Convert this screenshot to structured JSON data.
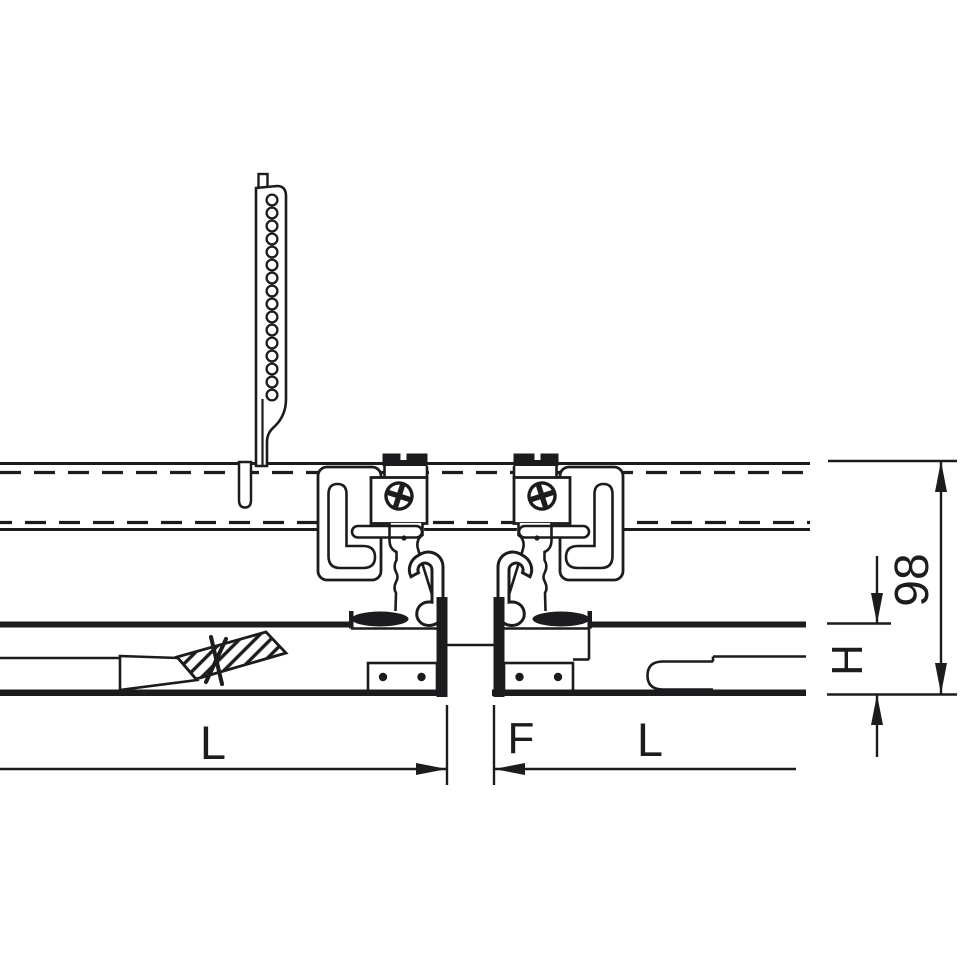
{
  "diagram": {
    "title": "suspended-ceiling-profile-joint-cross-section",
    "labels": {
      "length_left": "L",
      "gap": "F",
      "length_right": "L",
      "height": "H",
      "total_height": "98"
    },
    "colors": {
      "line": "#1c1c1e",
      "background": "#ffffff"
    },
    "hanger": {
      "hole_count": 16
    },
    "fasteners": {
      "screw_count": 2,
      "rivet_count": 4
    }
  }
}
